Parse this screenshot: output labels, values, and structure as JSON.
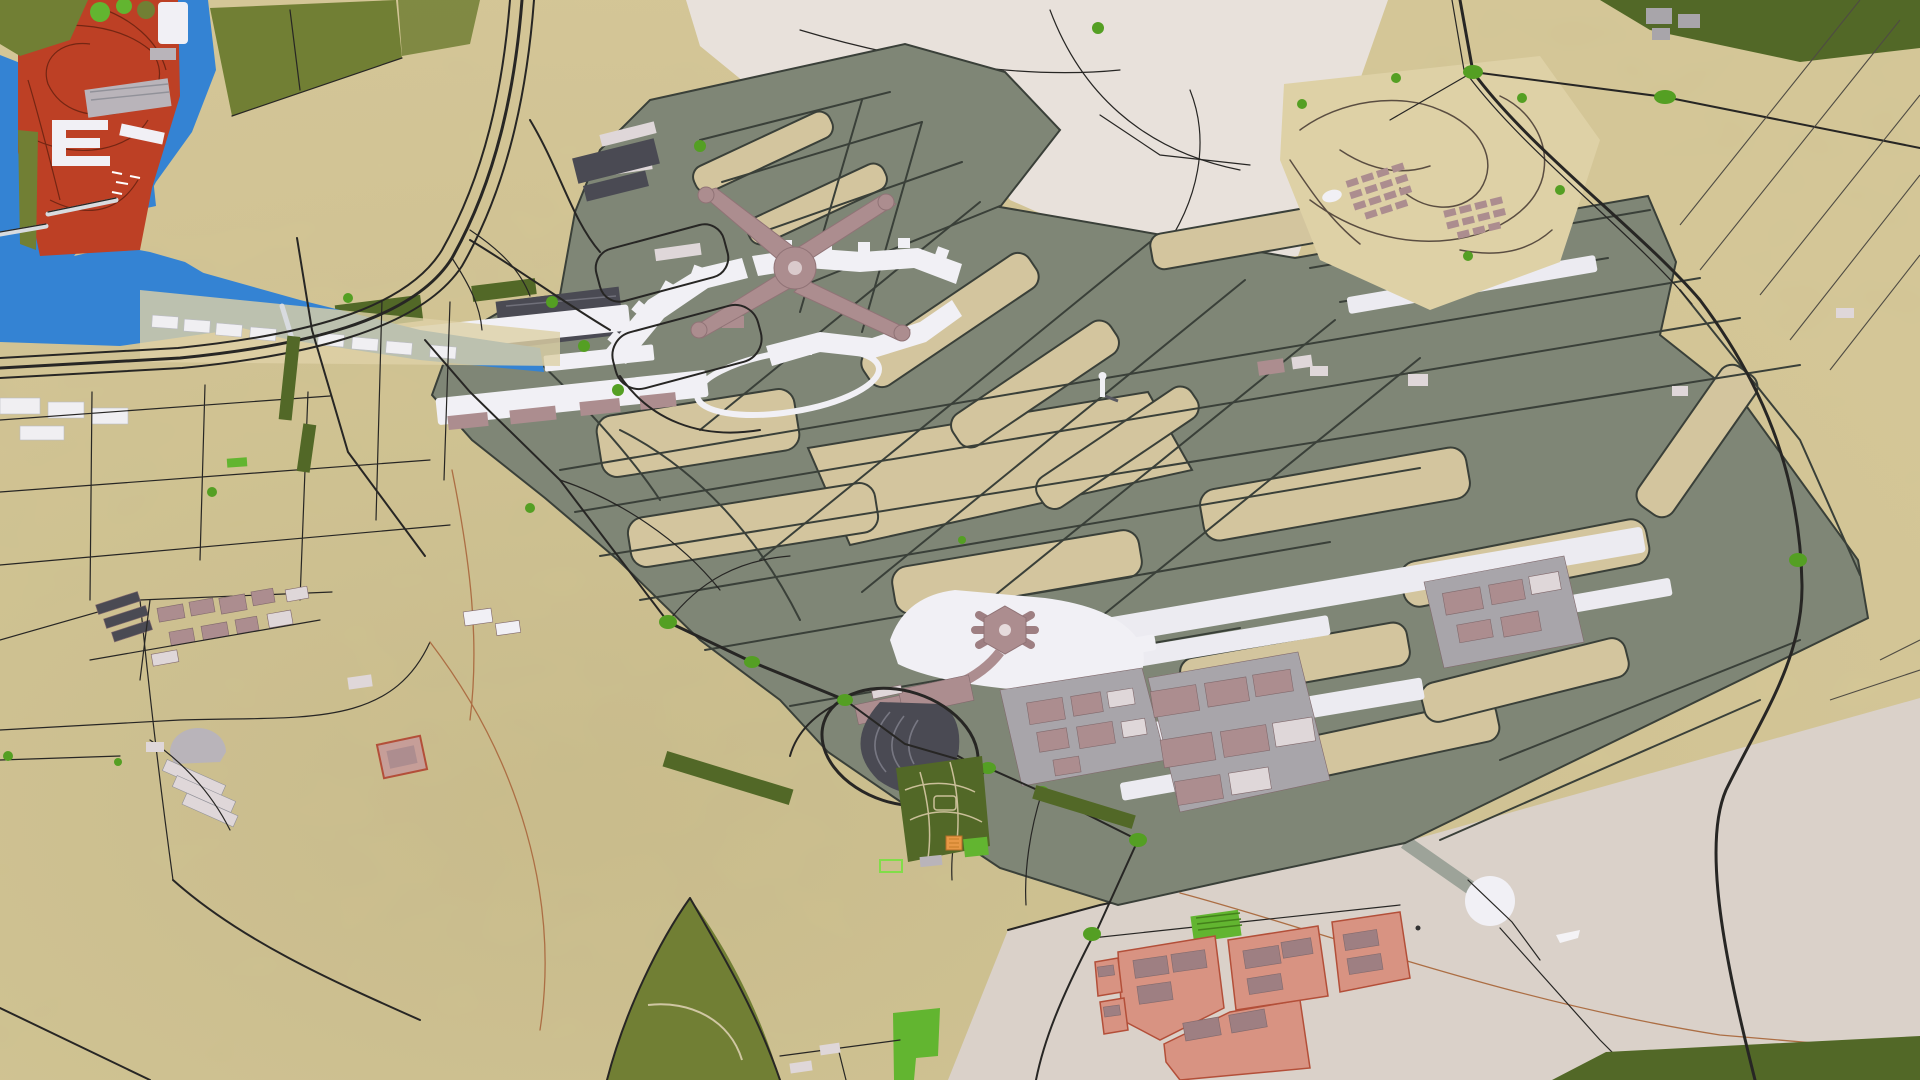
{
  "meta": {
    "view": "aerial-3d-render",
    "subject": "airport-masterplan-map",
    "resolution": {
      "w": 1920,
      "h": 1080
    }
  },
  "palette": {
    "sand": "#d4c694",
    "sand2": "#c9b987",
    "sand3": "#ddd0a4",
    "pale": "#e8e0da",
    "paved": "#d9d0c8",
    "olive": "#7b8372",
    "olive2": "#727a6a",
    "infield": "#d2c49b",
    "taxi": "#343a33",
    "white": "#f1f0f5",
    "runway": "#ecebf1",
    "water": "#2e7fd2",
    "red": "#bb3a1e",
    "redline": "#701f0c",
    "gfield": "#6d7b2e",
    "gdark": "#4d6420",
    "gbright": "#5db32a",
    "round": "#4f9c1c",
    "mauve": "#aa8a8c",
    "mauve2": "#9b7b7e",
    "roofw": "#ded6d8",
    "bgray": "#b7b2b8",
    "graypad": "#a6a3a8",
    "dark": "#45454e",
    "road": "#201f1d",
    "orange": "#aa6a3e",
    "salmon": "#d7907e",
    "salmonLine": "#b14a33"
  },
  "features": [
    {
      "id": "leisure-island-district",
      "label": "Red leisure island with race circuit and marina",
      "color_ref": "red"
    },
    {
      "id": "marina-water",
      "label": "Sea channel and marina water",
      "color_ref": "water"
    },
    {
      "id": "coastal-green-field",
      "label": "Irrigated green field near coast",
      "color_ref": "gfield"
    },
    {
      "id": "cleared-development-site",
      "label": "Pale cleared land north of airfield",
      "color_ref": "pale"
    },
    {
      "id": "airfield-apron",
      "label": "Olive airfield apron and taxiway system",
      "color_ref": "olive"
    },
    {
      "id": "midfield-terminal-x",
      "label": "X-shaped midfield passenger terminal",
      "color_ref": "mauve"
    },
    {
      "id": "terminal-concourses",
      "label": "White concourse piers and gates",
      "color_ref": "white"
    },
    {
      "id": "runway-south",
      "label": "South runway strip",
      "color_ref": "runway"
    },
    {
      "id": "runway-north",
      "label": "North-east runway strip",
      "color_ref": "runway"
    },
    {
      "id": "control-tower",
      "label": "Air traffic control tower",
      "color_ref": "white"
    },
    {
      "id": "existing-terminal-hexagon",
      "label": "Existing hexagonal satellite terminal",
      "color_ref": "mauve"
    },
    {
      "id": "parking-fan",
      "label": "Fan-shaped multi-storey car park",
      "color_ref": "dark"
    },
    {
      "id": "cargo-warehouse-district",
      "label": "Cargo and support warehouses",
      "color_ref": "mauve"
    },
    {
      "id": "residential-community",
      "label": "Planned residential community north-east",
      "color_ref": "sand"
    },
    {
      "id": "staff-housing-plots",
      "label": "Salmon staff-housing plots south-east",
      "color_ref": "salmon"
    },
    {
      "id": "landscape-golf-field",
      "label": "Dark green landscaped field with paths",
      "color_ref": "gdark"
    },
    {
      "id": "desert-plains",
      "label": "Desert plains with plot boundary lines",
      "color_ref": "sand"
    },
    {
      "id": "highway-west",
      "label": "Multi-lane highway west of airport",
      "color_ref": "road"
    },
    {
      "id": "highway-east",
      "label": "Eastern perimeter highway",
      "color_ref": "road"
    },
    {
      "id": "roundabouts",
      "label": "Green landscaped roundabouts",
      "color_ref": "round"
    },
    {
      "id": "white-circle-pad",
      "label": "Circular white pad south-east",
      "color_ref": "white"
    }
  ]
}
